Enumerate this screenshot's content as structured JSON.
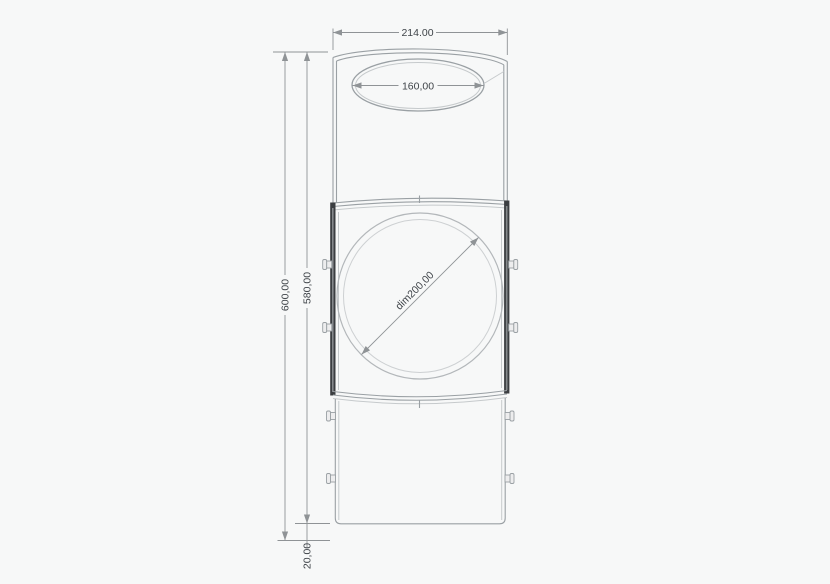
{
  "drawing": {
    "dimensions": {
      "overall_width": "214.00",
      "opening_width": "160,00",
      "total_height": "600,00",
      "body_height": "580,00",
      "base_clearance": "20,00",
      "door_diameter": "dim200,00"
    },
    "colors": {
      "background": "#f7f8f8",
      "line": "#9aa0a4",
      "light_line": "#c6cacc",
      "dark_frame": "#3b3e41",
      "dimension_line": "#8f9396",
      "dimension_text": "#3f4449"
    }
  }
}
